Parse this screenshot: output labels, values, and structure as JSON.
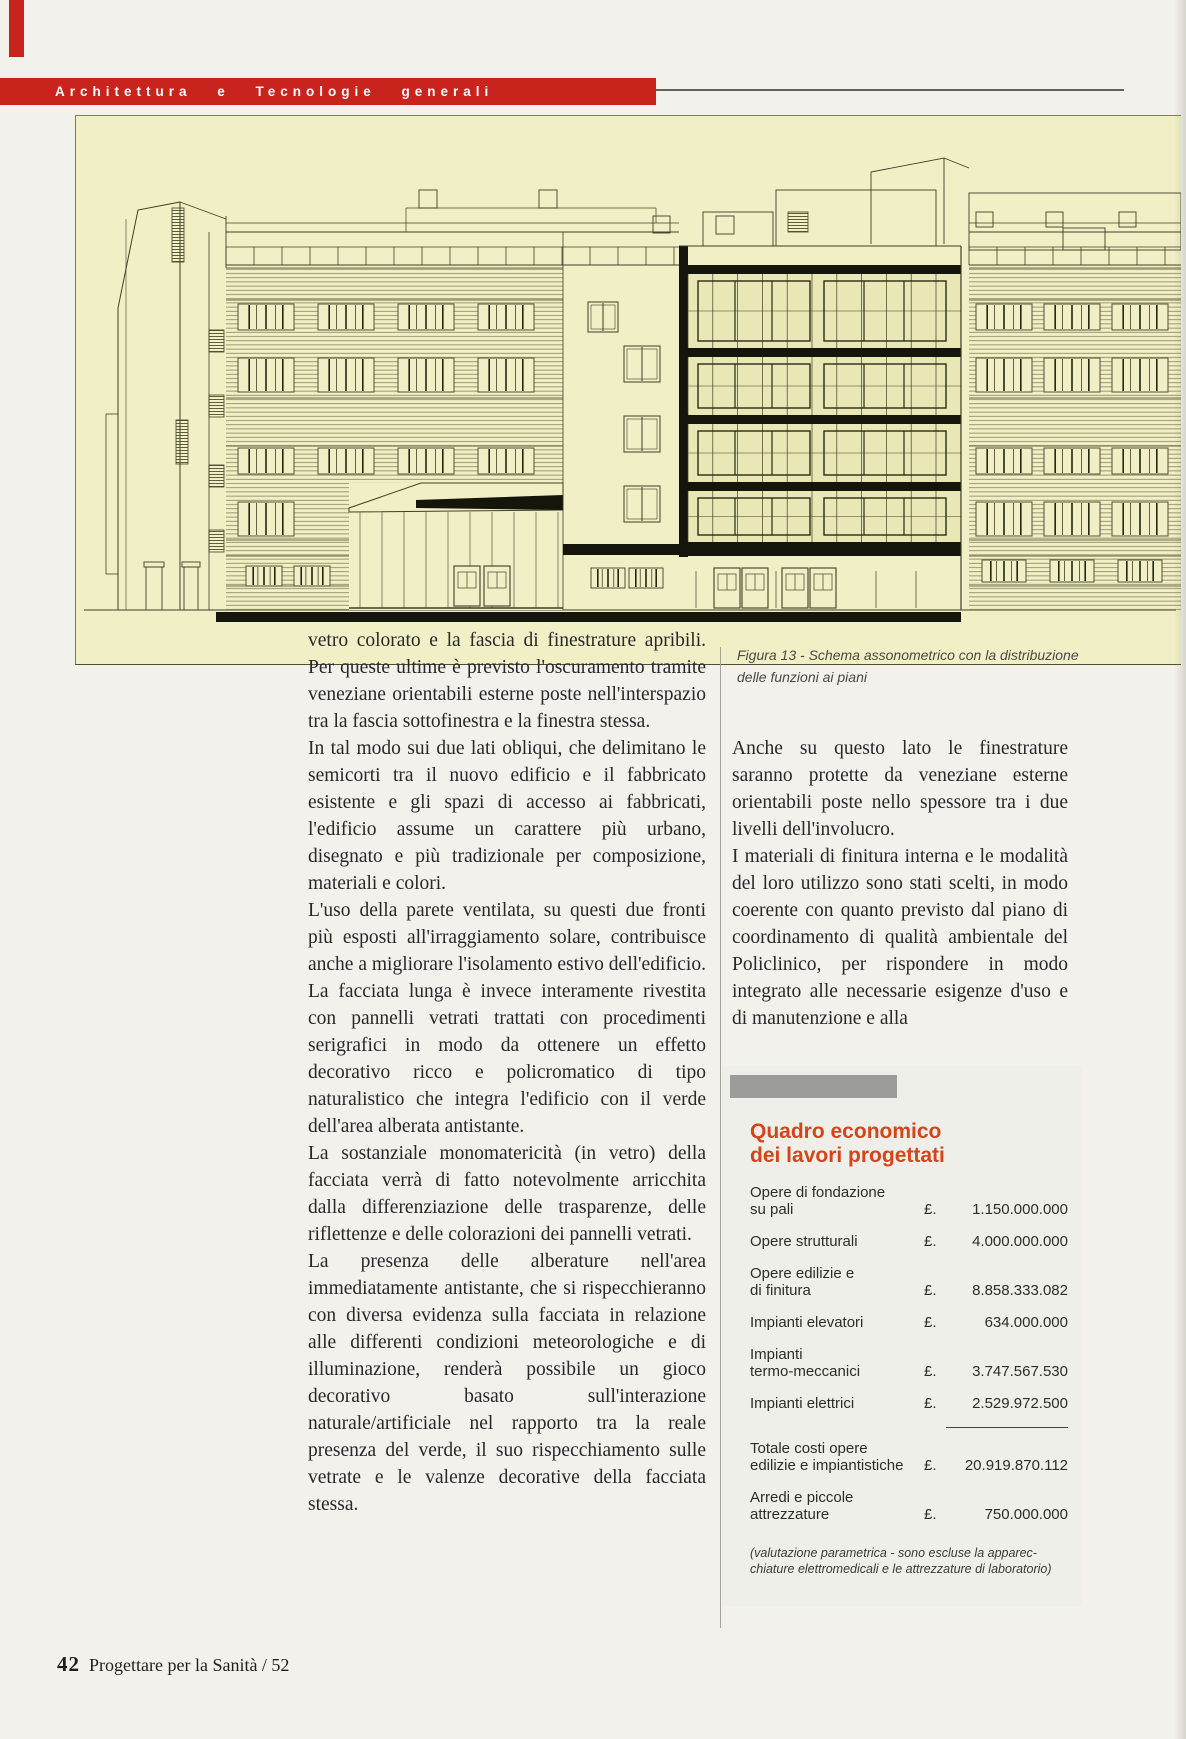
{
  "header": {
    "section_title": "Architettura e Tecnologie generali"
  },
  "figure": {
    "caption_lines": [
      "Figura 13 - Schema assonometrico con la distribuzione",
      "delle funzioni ai piani"
    ]
  },
  "article": {
    "left_column": [
      "vetro colorato e la fascia di finestrature apribili. Per queste ultime è previsto l'oscuramento tramite veneziane orientabili esterne poste nell'interspazio tra la fascia sottofinestra e la finestra stessa.",
      "In tal modo sui due lati obliqui, che delimitano le semicorti tra il nuovo edificio e il fabbricato esistente e gli spazi di accesso ai fabbricati, l'edificio assume un carattere più urbano, disegnato e più tradizionale per composizione, materiali e colori.",
      "L'uso della parete ventilata, su questi due fronti più esposti all'irraggiamento solare, contribuisce anche a migliorare l'isolamento estivo dell'edificio.",
      "La facciata lunga è invece interamente rivestita con pannelli vetrati trattati con procedimenti serigrafici in modo da ottenere un effetto decorativo ricco e policromatico di tipo naturalistico che integra l'edificio con il verde dell'area alberata antistante.",
      "La sostanziale monomatericità (in vetro) della facciata verrà di fatto notevolmente arricchita dalla differenziazione delle trasparenze, delle riflettenze e delle colorazioni dei pannelli vetrati.",
      "La presenza delle alberature nell'area immediatamente antistante, che si rispecchieranno con diversa evidenza sulla facciata in relazione alle differenti condizioni meteorologiche e di illuminazione, renderà possibile un gioco decorativo basato sull'interazione naturale/artificiale nel rapporto tra la reale presenza del verde, il suo rispecchiamento sulle vetrate e le valenze decorative della facciata stessa."
    ],
    "right_column": [
      "Anche su questo lato le finestrature saranno protette da veneziane esterne orientabili poste nello spessore tra i due livelli dell'involucro.",
      "I materiali di finitura interna e le modalità del loro utilizzo sono stati scelti, in modo coerente con quanto previsto dal piano di coordinamento di qualità ambientale del Policlinico, per rispondere in modo integrato alle necessarie esigenze d'uso e di manutenzione e alla"
    ]
  },
  "cost_table": {
    "title_lines": [
      "Quadro economico",
      "dei lavori progettati"
    ],
    "currency_symbol": "£.",
    "rows": [
      {
        "label": [
          "Opere di fondazione",
          "su pali"
        ],
        "value": "1.150.000.000"
      },
      {
        "label": [
          "Opere strutturali"
        ],
        "value": "4.000.000.000"
      },
      {
        "label": [
          "Opere edilizie e",
          "di finitura"
        ],
        "value": "8.858.333.082"
      },
      {
        "label": [
          "Impianti elevatori"
        ],
        "value": "634.000.000"
      },
      {
        "label": [
          "Impianti",
          "termo-meccanici"
        ],
        "value": "3.747.567.530"
      },
      {
        "label": [
          "Impianti elettrici"
        ],
        "value": "2.529.972.500"
      },
      {
        "label": [
          "Totale costi opere",
          "edilizie e impiantistiche"
        ],
        "value": "20.919.870.112",
        "separator_above": true
      },
      {
        "label": [
          "Arredi e piccole",
          "attrezzature"
        ],
        "value": "750.000.000"
      }
    ],
    "footnote_lines": [
      "(valutazione parametrica - sono escluse la apparec-",
      "chiature elettromedicali e le attrezzature di laboratorio)"
    ]
  },
  "footer": {
    "page_number": "42",
    "journal": "Progettare per la Sanità / 52"
  },
  "colors": {
    "accent_red": "#c8231d",
    "table_title_red": "#d4451c",
    "drawing_background": "#f1efc6",
    "drawing_line": "#3e4026"
  }
}
